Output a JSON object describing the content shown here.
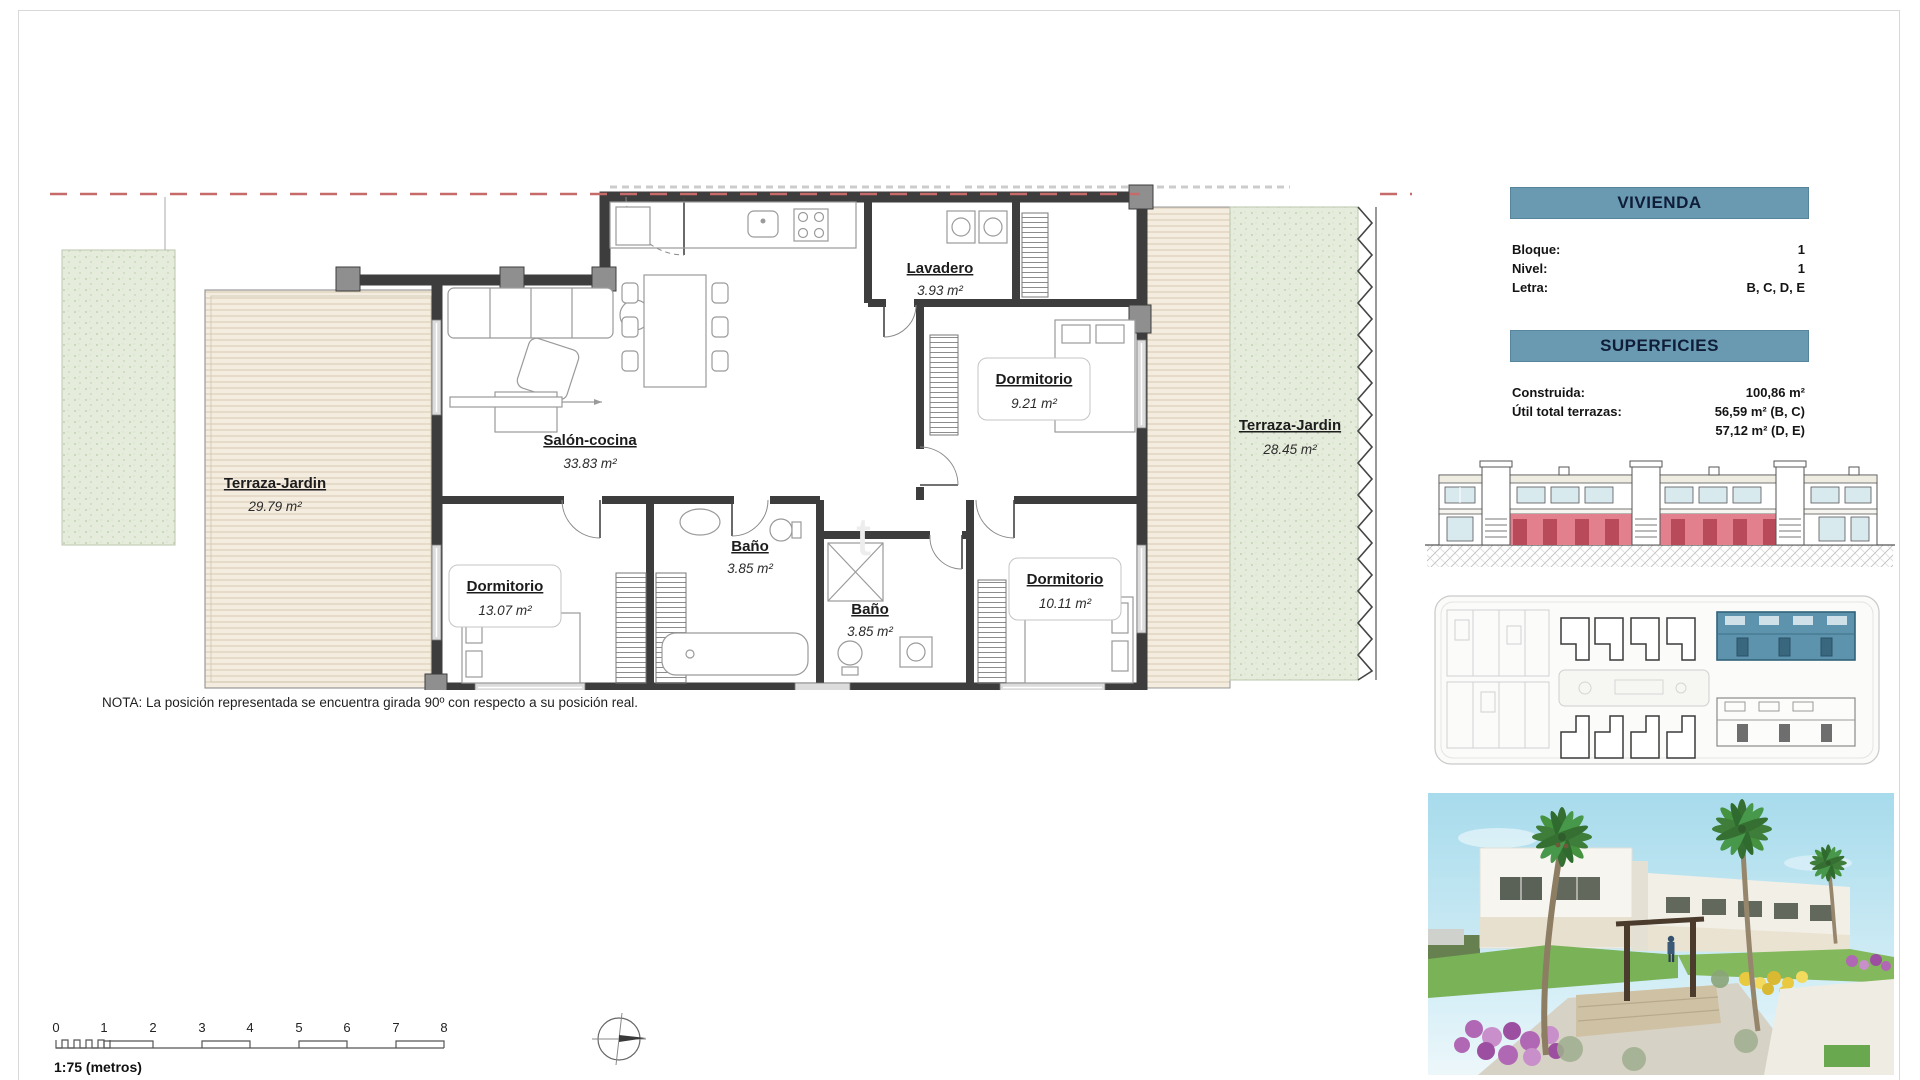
{
  "page": {
    "note": "NOTA: La posición representada se encuentra girada 90º con respecto a su posición real.",
    "scale_label": "1:75 (metros)"
  },
  "scale_ticks": [
    "0",
    "1",
    "2",
    "3",
    "4",
    "5",
    "6",
    "7",
    "8"
  ],
  "rooms": {
    "terraza_left": {
      "name": "Terraza-Jardin",
      "area": "29.79 m²"
    },
    "salon": {
      "name": "Salón-cocina",
      "area": "33.83 m²"
    },
    "lavadero": {
      "name": "Lavadero",
      "area": "3.93 m²"
    },
    "dorm_top": {
      "name": "Dormitorio",
      "area": "9.21 m²"
    },
    "dorm_left": {
      "name": "Dormitorio",
      "area": "13.07 m²"
    },
    "bano1": {
      "name": "Baño",
      "area": "3.85 m²"
    },
    "bano2": {
      "name": "Baño",
      "area": "3.85 m²"
    },
    "dorm_right": {
      "name": "Dormitorio",
      "area": "10.11 m²"
    },
    "terraza_right": {
      "name": "Terraza-Jardin",
      "area": "28.45 m²"
    }
  },
  "panel": {
    "vivienda": {
      "title": "VIVIENDA",
      "rows": [
        {
          "label": "Bloque:",
          "value": "1"
        },
        {
          "label": "Nivel:",
          "value": "1"
        },
        {
          "label": "Letra:",
          "value": "B, C, D, E"
        }
      ]
    },
    "superficies": {
      "title": "SUPERFICIES",
      "rows": [
        {
          "label": "Construida:",
          "value": "100,86 m²"
        },
        {
          "label": "Útil total terrazas:",
          "value": "56,59 m² (B, C)"
        },
        {
          "label": "",
          "value": "57,12 m² (D, E)"
        }
      ]
    }
  },
  "colors": {
    "header_band": "#6a9ab1",
    "boundary_dash": "#c66a6a",
    "highlight_red": "#e2808e",
    "highlight_blue": "#5e93ad",
    "deck": "#f3ecdf",
    "grass": "#e6ecdc"
  }
}
